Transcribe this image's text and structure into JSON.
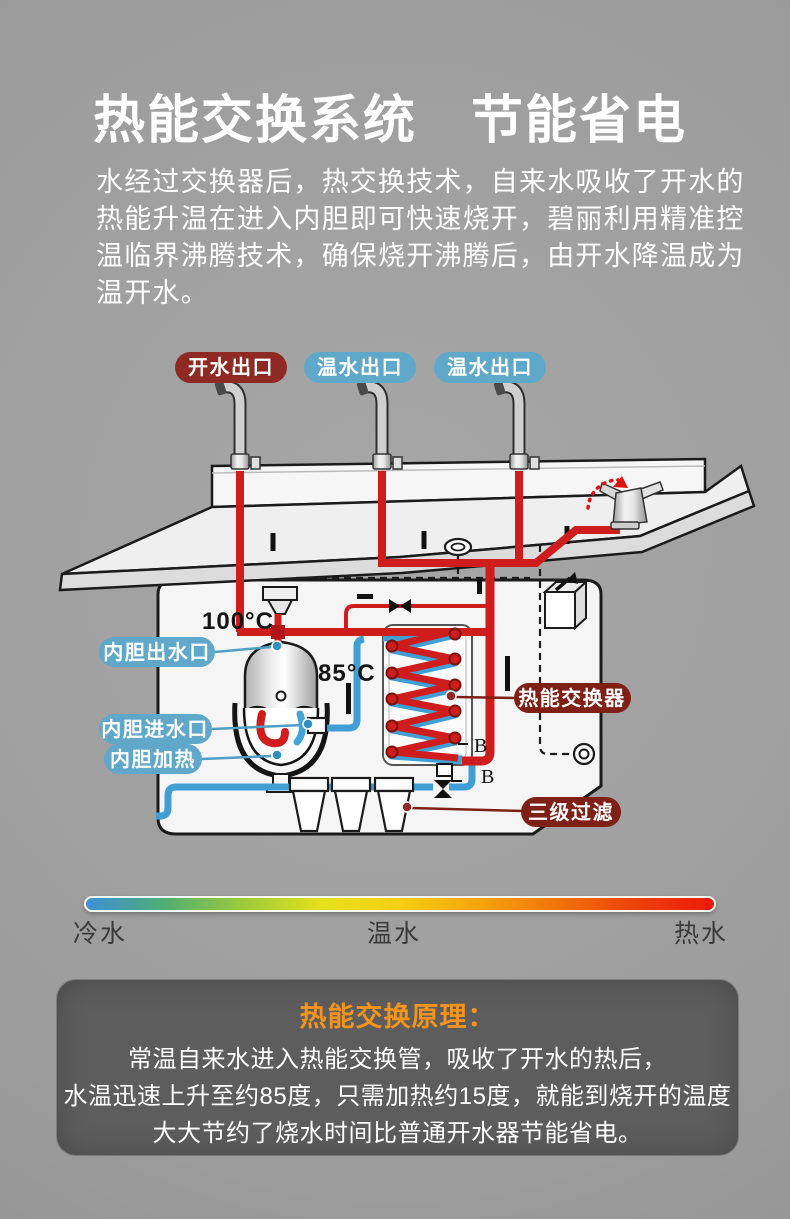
{
  "header": {
    "title": "热能交换系统　节能省电",
    "paragraph_lines": [
      "水经过交换器后，热交换技术，自来水吸收了开水的",
      "热能升温在进入内胆即可快速烧开，碧丽利用精准控",
      "温临界沸腾技术，确保烧开沸腾后，由开水降温成为",
      "温开水。"
    ]
  },
  "diagram": {
    "outlet_labels": [
      "开水出口",
      "温水出口",
      "温水出口"
    ],
    "tank_outlet_label": "内胆出水口",
    "tank_inlet_label": "内胆进水口",
    "tank_heater_label": "内胆加热",
    "heat_exchanger_label": "热能交换器",
    "triple_filter_label": "三级过滤",
    "temp_high": "100°C",
    "temp_warm": "85°C",
    "marker_b1": "B",
    "marker_b2": "B"
  },
  "legend": {
    "labels": [
      "冷水",
      "温水",
      "热水"
    ],
    "bar_colors": [
      "#3e8fd8",
      "#52ad72",
      "#9ccb3b",
      "#e5e11e",
      "#f6ce13",
      "#f5a50d",
      "#f0740a",
      "#ee4108",
      "#ec1808"
    ]
  },
  "principle_box": {
    "title": "热能交换原理：",
    "lines": [
      "常温自来水进入热能交换管，吸收了开水的热后，",
      "水温迅速上升至约85度，只需加热约15度，就能到烧开的温度",
      "大大节约了烧水时间比普通开水器节能省电。"
    ]
  },
  "colors": {
    "pill_maroon": "#8e2a23",
    "pill_dark_red": "#7e2016",
    "pill_blue": "#60a8ca",
    "pipe_red": "#cf1d1d",
    "pipe_blue": "#3f9fd4",
    "principle_title_orange": "#f5941d",
    "background_gray": "#9b9b9b",
    "principle_box_bg": "#5d5d5d"
  }
}
